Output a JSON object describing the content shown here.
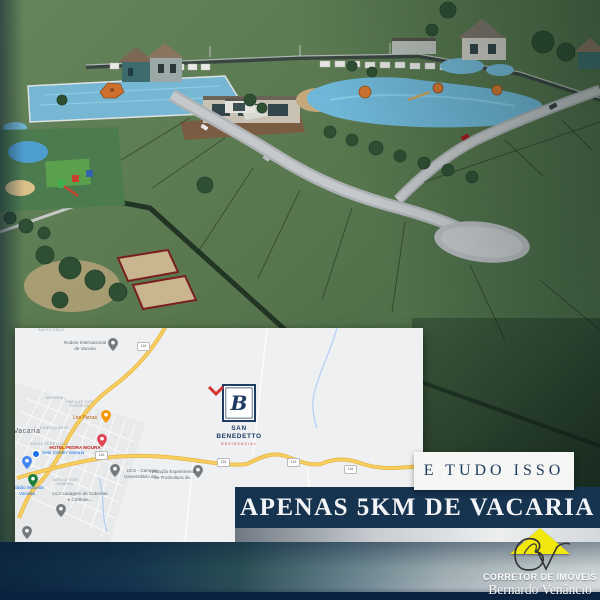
{
  "ad": {
    "tagline_top": "E TUDO ISSO",
    "tagline_main": "APENAS 5KM DE VACARIA"
  },
  "development": {
    "monogram": "B",
    "name_line1": "SAN",
    "name_line2": "BENEDETTO",
    "subtitle": "RESIDENCIAL"
  },
  "map": {
    "shield_text": "116",
    "labels": [
      {
        "text": "SANTA CRUZ"
      },
      {
        "text": "Rodeio Internacional de Vacaria"
      },
      {
        "text": "IMPERIAL"
      },
      {
        "text": "PARQUE DOS RODEIOS"
      },
      {
        "text": "Les Pizzas"
      },
      {
        "text": "CHARQUINHO"
      },
      {
        "text": "Vacaria"
      },
      {
        "text": "SANTA TEREZINHA"
      },
      {
        "text": "HOTEL PEDRA MOURA"
      },
      {
        "text": "Sesi Center Vacaria"
      },
      {
        "text": "JARDIM DOS PAMPAS"
      },
      {
        "text": "Estádio Macedo Vacaria"
      },
      {
        "text": "LCA Lavagem de Cobertas e Cortinas..."
      },
      {
        "text": "UCS - Campus Universitário de..."
      },
      {
        "text": "Estação Experimental de Fruticultura de..."
      }
    ]
  },
  "broker": {
    "category": "CORRETOR DE IMÓVEIS",
    "name": "Bernardo Venâncio"
  },
  "colors": {
    "brand_navy": "#16334f",
    "logo_yellow": "#f2e70c",
    "map_road_yellow": "#f7cf5e",
    "render_green": "#597a50"
  }
}
